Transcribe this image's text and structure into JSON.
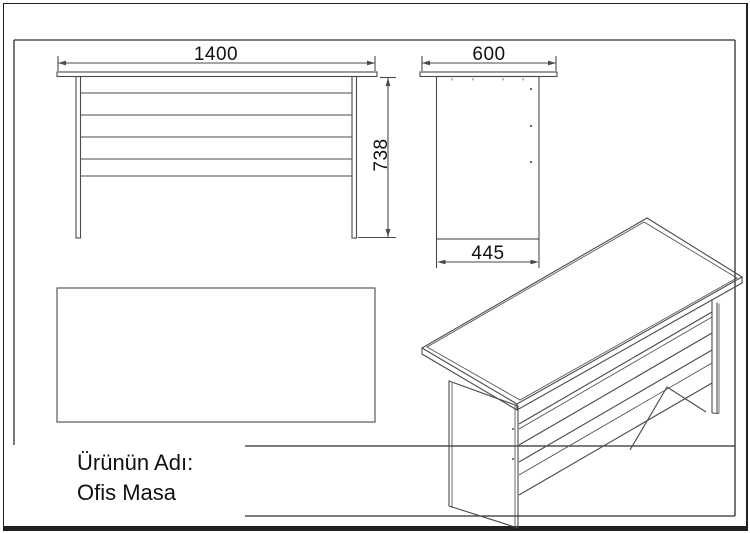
{
  "drawing": {
    "background": "#ffffff",
    "line_color": "#4a4a4a",
    "frame_color": "#2e2e2e",
    "text_color": "#111111"
  },
  "dimensions": {
    "width": "1400",
    "height": "738",
    "depth": "600",
    "base_depth": "445"
  },
  "title_block": {
    "label": "Ürünün Adı:",
    "product_name": "Ofis Masa"
  }
}
